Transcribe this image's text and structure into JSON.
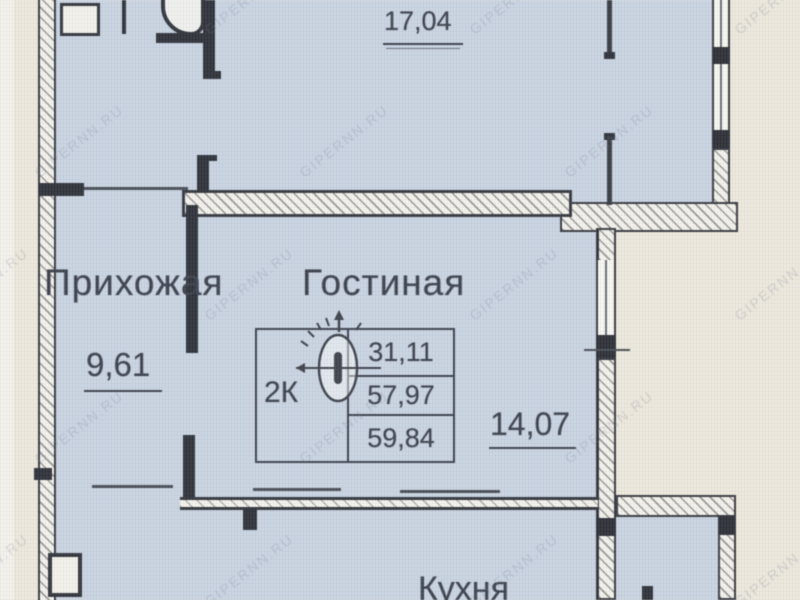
{
  "watermark": {
    "text": "GIPERNN.RU"
  },
  "rooms": {
    "top_room": {
      "area": "17,04"
    },
    "hallway": {
      "label": "Прихожая",
      "area": "9,61"
    },
    "living": {
      "label": "Гостиная",
      "area": "14,07"
    },
    "kitchen": {
      "label": "Кухня"
    }
  },
  "stamp": {
    "type_label": "2К",
    "areas": [
      "31,11",
      "57,97",
      "59,84"
    ]
  },
  "colors": {
    "room_fill": "#c9d3e1",
    "paper": "#ebe7dc",
    "wall_dark": "#30333a",
    "text": "#3d424d",
    "watermark": "#7a8296"
  }
}
